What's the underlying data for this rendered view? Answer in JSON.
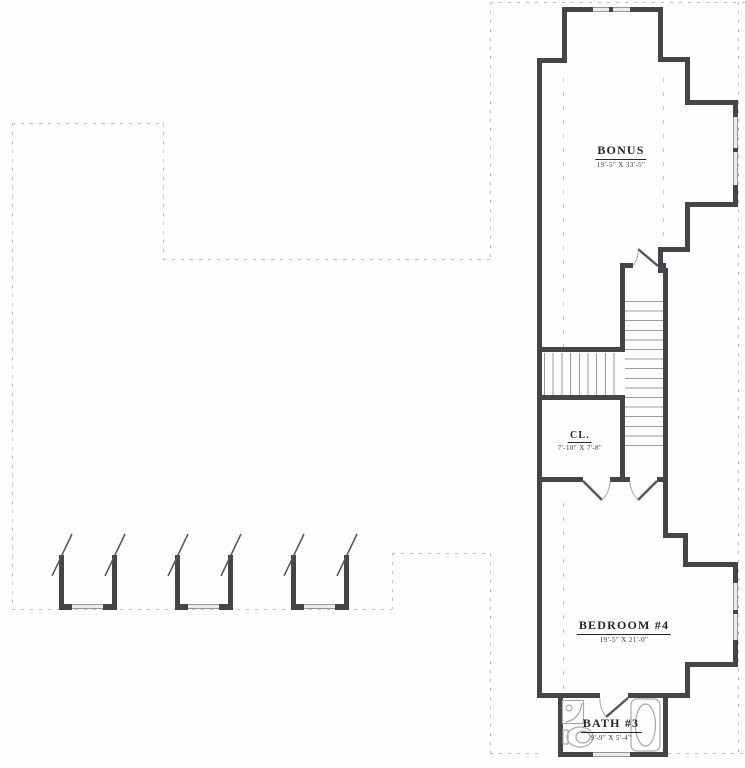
{
  "plan": {
    "rooms": {
      "bonus": {
        "label": "BONUS",
        "dims": "19'-5\" X 33'-5\""
      },
      "closet": {
        "label": "CL.",
        "dims": "7'-10\" X 7'-8\""
      },
      "bedroom4": {
        "label": "BEDROOM  #4",
        "dims": "19'-5\" X 21'-0\""
      },
      "bath3": {
        "label": "BATH  #3",
        "dims": "9'-9\" X 5'-4\""
      }
    },
    "colors": {
      "wall": "#454549",
      "window": "#ececee",
      "dashed_outline": "#bfbfc4",
      "stair_tread": "#9b9ba0",
      "text": "#26262a"
    }
  }
}
